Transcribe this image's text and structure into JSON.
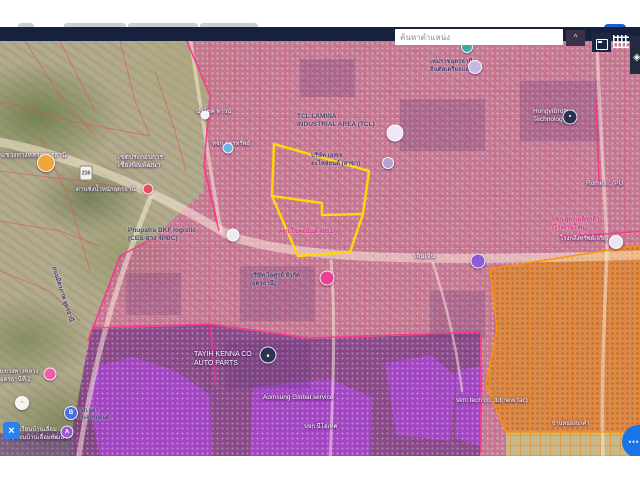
{
  "search": {
    "placeholder": "ค้นหาตำแหน่ง",
    "collapse_glyph": "^"
  },
  "controls": {
    "fab_glyph": "⋯",
    "close_glyph": "×",
    "layers_glyph": "◈"
  },
  "browser": {
    "bar_color": "#16213e",
    "tabs": [
      {
        "x": 18,
        "w": 16
      },
      {
        "x": 64,
        "w": 62
      },
      {
        "x": 128,
        "w": 70
      },
      {
        "x": 200,
        "w": 58
      }
    ],
    "red_segment": {
      "x": 262,
      "w": 46
    },
    "blue_segment": {
      "x": 604,
      "w": 22
    }
  },
  "colors": {
    "parcel_outline": "#ffd60a",
    "zone_boundary": "#ff2e8a",
    "orange_boundary": "#ff9100",
    "road": "rgba(255,242,222,0.5)",
    "satellite_parcel_line": "rgba(222,82,96,0.6)",
    "fab_blue": "#1b74e8"
  },
  "map": {
    "zones": [
      {
        "name": "industrial-magenta-zone",
        "cls": "zone-magenta",
        "clip": "polygon(186px 0px,640px 0px,640px 415px,70px 415px,88px 300px,120px 215px,152px 198px,204px 150px,204px 125px,210px 55px)"
      },
      {
        "name": "dark-purple-zone",
        "cls": "zone-dark",
        "clip": "polygon(92px 288px,210px 284px,310px 298px,480px 292px,480px 415px,0px 415px,0px 392px,72px 390px,82px 336px)"
      },
      {
        "name": "violet-blob-1",
        "cls": "zone-violet",
        "clip": "polygon(97px 325px,133px 316px,176px 330px,210px 354px,212px 415px,100px 415px,88px 360px)"
      },
      {
        "name": "violet-blob-2",
        "cls": "zone-violet",
        "clip": "polygon(253px 346px,330px 338px,372px 356px,370px 415px,250px 415px)"
      },
      {
        "name": "violet-blob-3",
        "cls": "zone-violet",
        "clip": "polygon(385px 322px,432px 314px,456px 336px,450px 400px,396px 394px)"
      },
      {
        "name": "violet-blob-4",
        "cls": "zone-violet",
        "clip": "polygon(456px 330px,483px 324px,481px 406px,455px 396px)"
      },
      {
        "name": "orange-zone",
        "cls": "zone-orange",
        "clip": "polygon(490px 228px,640px 204px,640px 391px,506px 391px,486px 344px,497px 288px)"
      },
      {
        "name": "satellite-corner-patch",
        "cls": "zone-satpatch",
        "clip": "polygon(506px 391px,640px 391px,640px 415px,506px 415px)"
      }
    ],
    "satellite_lines": [
      "M0,60 L70,80 L150,95",
      "M25,0 L60,55 L95,95",
      "M0,130 L80,140 L150,150",
      "M0,180 L60,190 L100,205",
      "M40,95 L70,160 L90,230",
      "M120,0 L135,60 L150,95",
      "M0,230 L50,250 L80,280",
      "M155,30 L175,90 L186,130",
      "M60,0 L80,40 L95,70"
    ],
    "buildings": [
      "M240,225 h75 v55 h-75 z",
      "M400,58 h85 v52 h-85 z",
      "M300,18 h55 v38 h-55 z",
      "M126,232 h55 v42 h-55 z",
      "M430,250 h55 v48 h-55 z",
      "M520,40 h80 v60 h-80 z",
      "M225,300 h85 v48 h-85 z"
    ],
    "roads": [
      {
        "d": "M-5,100 C60,113 130,135 232,196 C300,216 390,222 645,214",
        "w": 9
      },
      {
        "d": "M152,152 C130,210 100,280 78,420",
        "w": 5
      },
      {
        "d": "M190,-4 C200,60 210,130 221,190",
        "w": 3.5
      },
      {
        "d": "M597,-4 C599,80 606,160 607,210 C604,280 601,350 603,420",
        "w": 3.5
      },
      {
        "d": "M331,220 C336,280 333,350 330,420",
        "w": 3
      },
      {
        "d": "M433,222 C447,265 457,310 462,350",
        "w": 2.5
      }
    ],
    "boundaries": [
      "M186,-2 L210,55 L204,125 L219,190",
      "M152,198 L120,215 L88,300",
      "M560,196 L645,190",
      "M596,58 L599,142",
      "M92,287 L210,283 L310,297 L480,291",
      "M210,283 L216,345",
      "M481,292 L481,412"
    ],
    "orange_boundaries": [
      "M490,228 L640,204",
      "M490,228 L497,288 L486,344 L506,391 L640,391"
    ],
    "parcel": {
      "outer": "274,103 369,130 363,173 350,211 298,215 272,155",
      "divider": "M272,155 L322,162 L322,174 L363,173"
    },
    "labels": [
      {
        "x": 1,
        "y": 111,
        "style": "light",
        "size": 6.5,
        "lines": [
          "แขวงทางหลวงอุดรธานี"
        ]
      },
      {
        "x": 118,
        "y": 113,
        "style": "light",
        "size": 6.5,
        "lines": [
          "เขตประกอบการ",
          "เชียงพิณพัฒนา"
        ]
      },
      {
        "x": 76,
        "y": 146,
        "style": "light",
        "size": 6,
        "lines": [
          "ด่านชั่งน้ำหนักอุดรธานี"
        ]
      },
      {
        "x": 196,
        "y": 68,
        "style": "light",
        "size": 6,
        "lines": [
          "นำโชค ทาวน์"
        ]
      },
      {
        "x": 212,
        "y": 100,
        "style": "light",
        "size": 6,
        "lines": [
          "หจก.อุดรทรัพย์"
        ]
      },
      {
        "x": 297,
        "y": 72,
        "style": "dark",
        "size": 6.5,
        "lines": [
          "TCL LAMINA",
          "INDUSTRIAL AREA (TCL)"
        ]
      },
      {
        "x": 311,
        "y": 112,
        "style": "dark",
        "size": 6,
        "lines": [
          "บริษัท เอสเจ",
          "อะไหล่ยนต์ (สาขา)"
        ]
      },
      {
        "x": 430,
        "y": 18,
        "style": "dark",
        "size": 6,
        "lines": [
          "เหมราชอุดรธานี",
          "อินดัสเตรียลแลนด์"
        ]
      },
      {
        "x": 128,
        "y": 186,
        "style": "dark",
        "size": 6.5,
        "lines": [
          "Phupatra BKF logistic",
          "(CES-ยาง 4PBC)"
        ]
      },
      {
        "x": 414,
        "y": 212,
        "style": "light",
        "size": 6.5,
        "lines": [
          "เจินเจิน"
        ]
      },
      {
        "x": 250,
        "y": 232,
        "style": "dark",
        "size": 6,
        "lines": [
          "บริษัท ไอศูรย์ จำกัด",
          "(อุดรธานี)"
        ]
      },
      {
        "x": 278,
        "y": 188,
        "style": "magenta",
        "size": 6,
        "lines": [
          "หจก.โชคอนันต์ 4961"
        ]
      },
      {
        "x": 194,
        "y": 310,
        "style": "light",
        "size": 7,
        "lines": [
          "TAYIH KENNA CO",
          "AUTO PARTS"
        ]
      },
      {
        "x": 263,
        "y": 353,
        "style": "light",
        "size": 6.5,
        "lines": [
          "Aomsung Global service"
        ]
      },
      {
        "x": 456,
        "y": 356,
        "style": "light",
        "size": 6.5,
        "lines": [
          "skm.tech co.,ltd(new fac)"
        ]
      },
      {
        "x": 533,
        "y": 67,
        "style": "light",
        "size": 6.5,
        "lines": [
          "HongyiBrother",
          "Technology"
        ]
      },
      {
        "x": 586,
        "y": 139,
        "style": "light",
        "size": 6.5,
        "lines": [
          "Romex ..(PU"
        ]
      },
      {
        "x": 552,
        "y": 176,
        "style": "magenta",
        "size": 6,
        "lines": [
          "บจก.อุดรเหล็กกล้า",
          "(โรงงานใหญ่)"
        ]
      },
      {
        "x": 560,
        "y": 195,
        "style": "light",
        "size": 6,
        "lines": [
          "โรงกลึงทรัพย์เจริญ"
        ]
      },
      {
        "x": 0,
        "y": 328,
        "style": "light",
        "size": 6,
        "lines": [
          "แขวงทางหลวง",
          "อุดรธานีที่ 2"
        ]
      },
      {
        "x": 10,
        "y": 386,
        "style": "light",
        "size": 6,
        "lines": [
          "โรงเรียนบ้านเลื่อม",
          "ชุมชนบ้านเลื่อมพัฒนา"
        ]
      },
      {
        "x": 77,
        "y": 367,
        "style": "dark",
        "size": 5.5,
        "lines": [
          "บจก.อุดร",
          "กระจกรถยนต์"
        ]
      },
      {
        "x": 304,
        "y": 383,
        "style": "light",
        "size": 6,
        "lines": [
          "บจก.นีโอเทค"
        ]
      },
      {
        "x": 552,
        "y": 380,
        "style": "light",
        "size": 5.5,
        "lines": [
          "บ้านหนองนาคำ"
        ]
      },
      {
        "x": 56,
        "y": 225,
        "style": "dark",
        "size": 6,
        "rotate": 72,
        "lines": [
          "ถนนมิตรภาพ อุดรธานี"
        ]
      }
    ],
    "pois": [
      {
        "name": "temple-poi",
        "x": 46,
        "y": 122,
        "size": 16,
        "bg": "#f2a33c"
      },
      {
        "name": "highway-shield",
        "x": 86,
        "y": 132,
        "shield": "216"
      },
      {
        "name": "red-poi",
        "x": 148,
        "y": 148,
        "size": 9,
        "bg": "#e8505b"
      },
      {
        "name": "white-poi-small",
        "x": 205,
        "y": 74,
        "size": 7,
        "bg": "#f5f0fa"
      },
      {
        "name": "blue-poi",
        "x": 228,
        "y": 107,
        "size": 9,
        "bg": "#6db3e8"
      },
      {
        "name": "logistic-poi",
        "x": 233,
        "y": 194,
        "size": 11,
        "bg": "#efe9f2"
      },
      {
        "name": "tcl-poi",
        "x": 395,
        "y": 92,
        "size": 15,
        "bg": "#efe7f5"
      },
      {
        "name": "parts-poi",
        "x": 388,
        "y": 122,
        "size": 10,
        "bg": "#b79fd4"
      },
      {
        "name": "pink-company-poi",
        "x": 327,
        "y": 237,
        "size": 13,
        "bg": "#e9408f"
      },
      {
        "name": "purple-poi",
        "x": 478,
        "y": 220,
        "size": 13,
        "bg": "#8e5bd6"
      },
      {
        "name": "estate-poi",
        "x": 475,
        "y": 26,
        "size": 12,
        "bg": "#c9b6e4"
      },
      {
        "name": "teal-poi",
        "x": 467,
        "y": 6,
        "size": 10,
        "bg": "#3aada8"
      },
      {
        "name": "hongyi-pin",
        "x": 570,
        "y": 76,
        "size": 13,
        "bg": "#2d3250",
        "glyph": "•"
      },
      {
        "name": "tayih-pin",
        "x": 268,
        "y": 314,
        "size": 15,
        "bg": "#2d3250",
        "glyph": "•"
      },
      {
        "name": "factory-poi",
        "x": 616,
        "y": 201,
        "size": 12,
        "bg": "#ece6f0"
      },
      {
        "name": "highway-office-poi",
        "x": 50,
        "y": 333,
        "size": 11,
        "bg": "#ef5da8"
      },
      {
        "name": "yellow-dot-poi",
        "x": 22,
        "y": 362,
        "size": 12,
        "bg": "#f7f4ee",
        "glyph": "•",
        "glyphColor": "#e0b32e"
      },
      {
        "name": "bank-poi",
        "x": 71,
        "y": 372,
        "size": 12,
        "bg": "#4a6fe3",
        "glyph": "B"
      },
      {
        "name": "school-poi",
        "x": 67,
        "y": 391,
        "size": 11,
        "bg": "#9b59d0",
        "glyph": "A"
      }
    ]
  }
}
